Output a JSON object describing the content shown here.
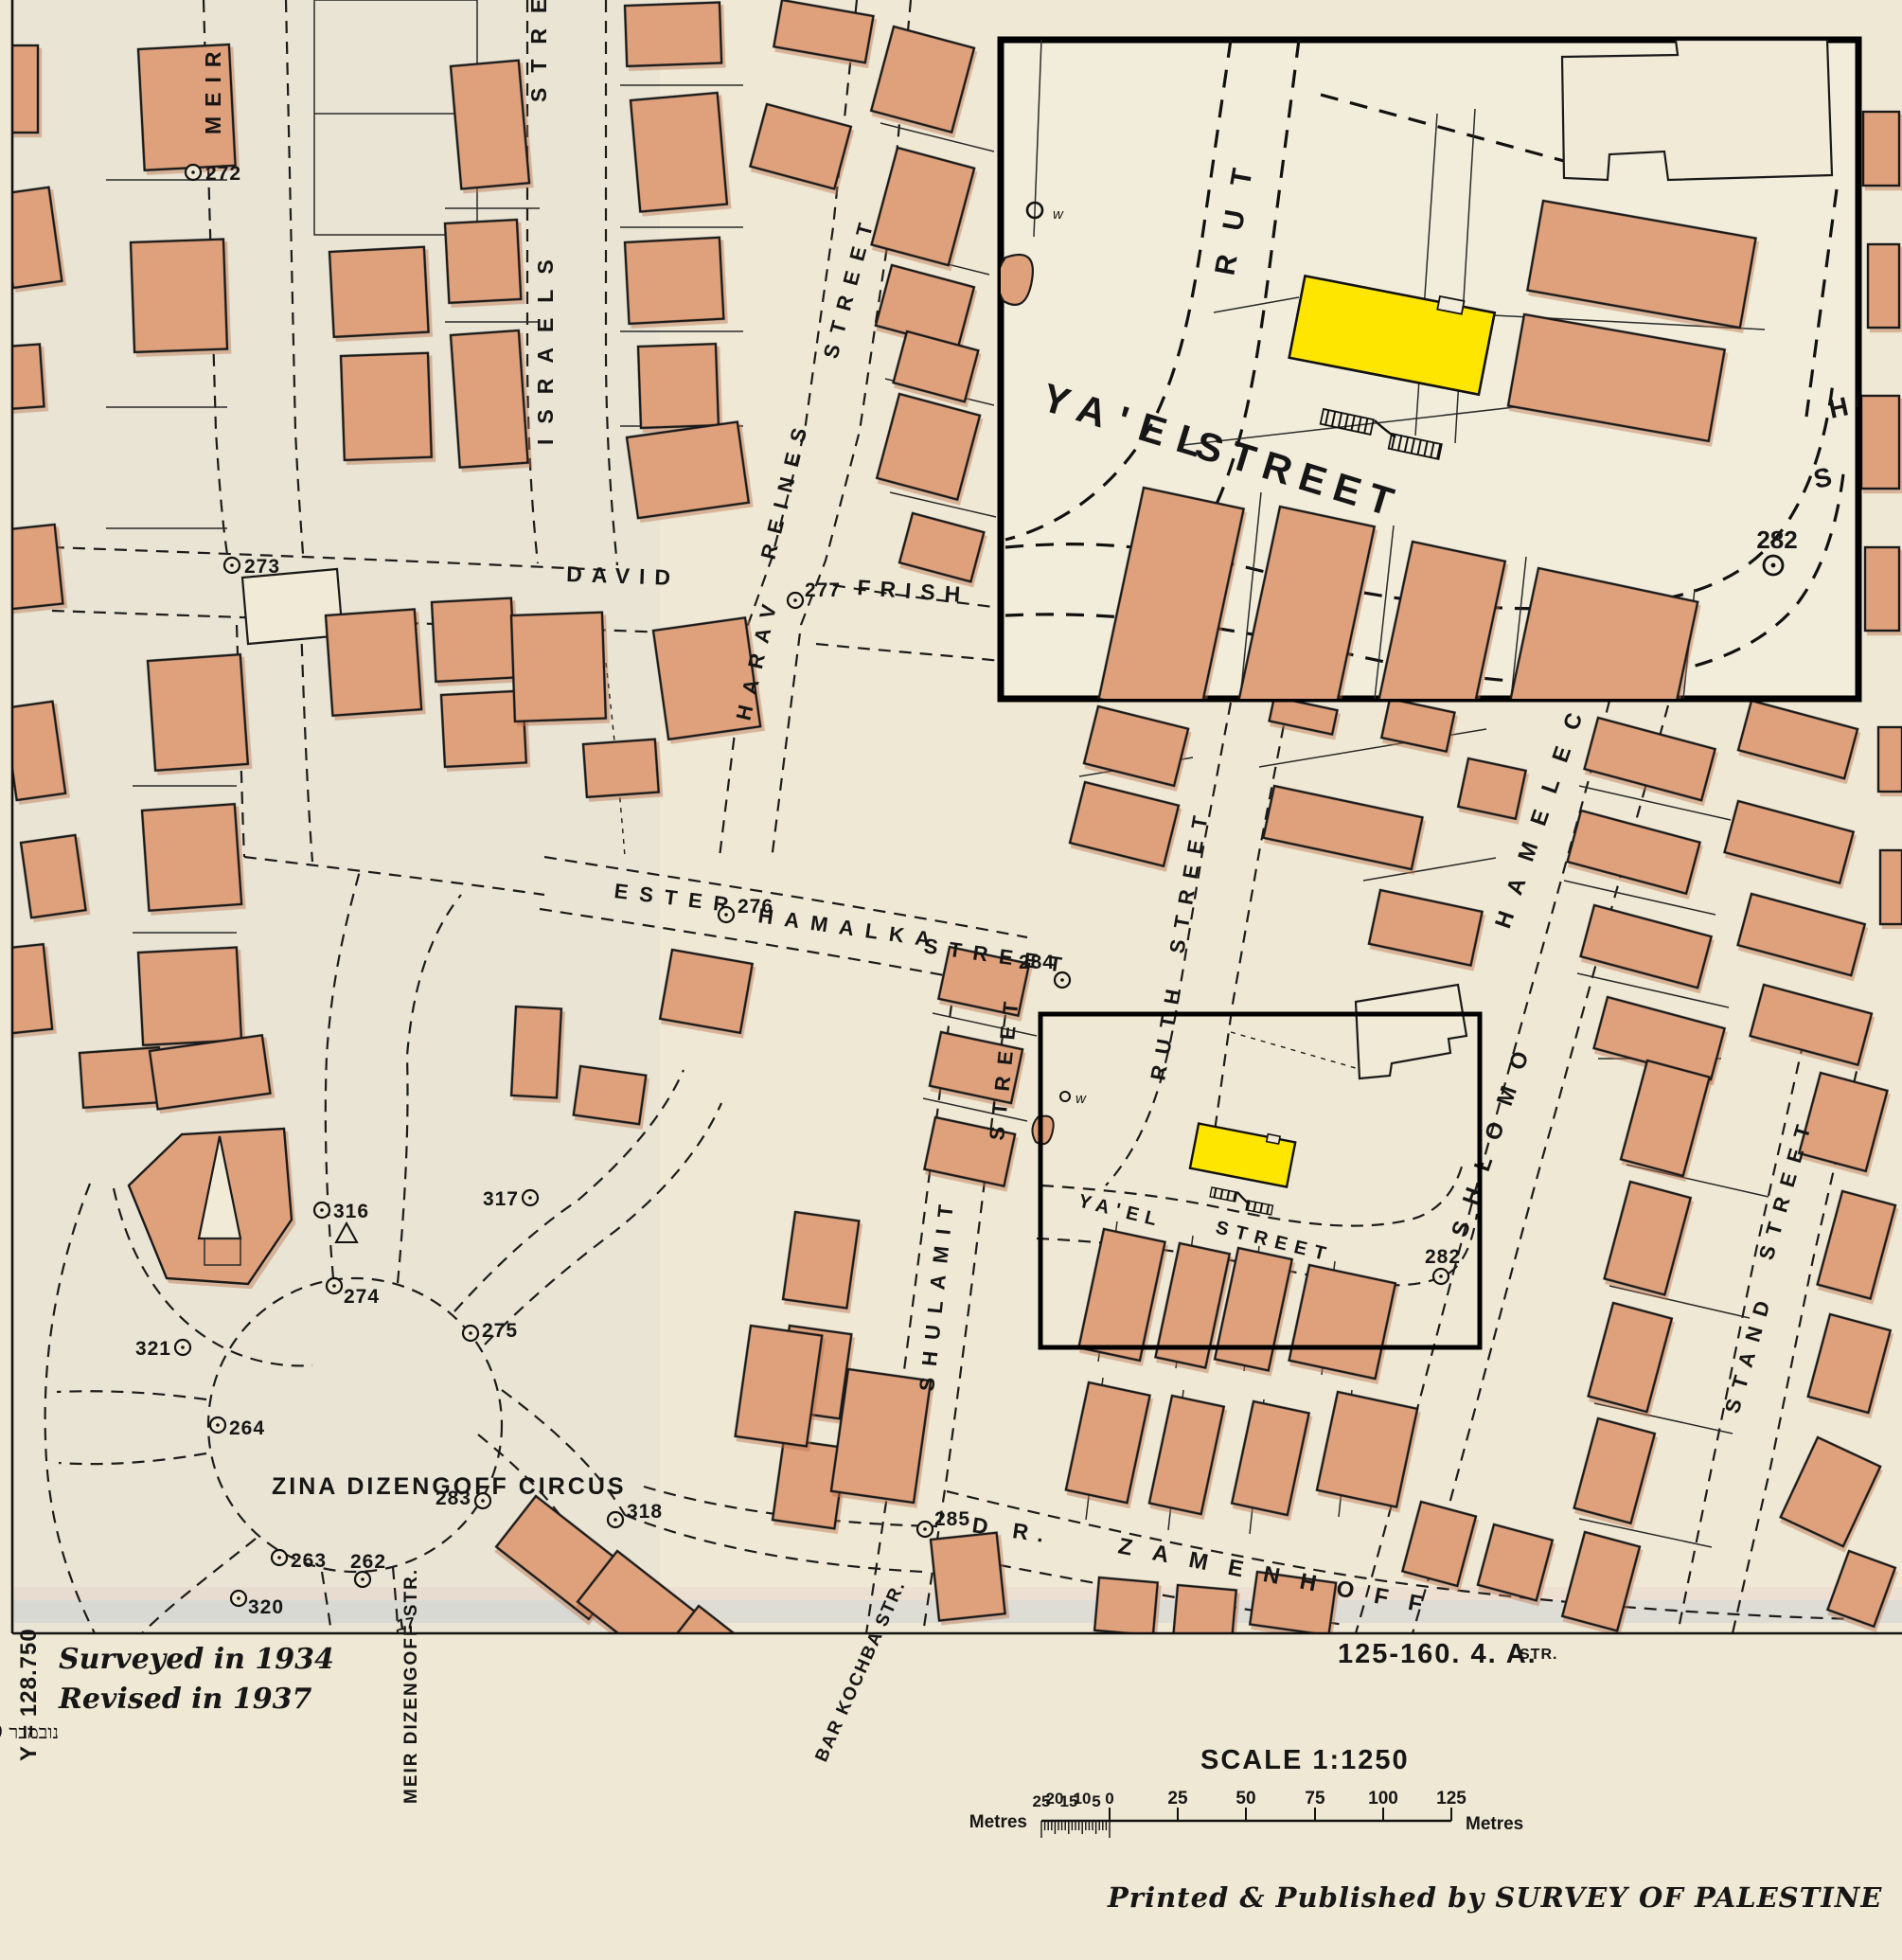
{
  "streets": {
    "meir": "MEIR",
    "israels": "ISRAELS",
    "israels_stre": "STRE",
    "harav": "HARAV",
    "reines": "REINES",
    "street_reines": "STREET",
    "david": "DAVID",
    "frish": "FRISH",
    "ester": "ESTER",
    "hamalka": "HAMALKA",
    "street_hamalka": "STREET",
    "shulamit": "SHULAMIT",
    "street_shulamit": "STREET",
    "ruth": "RUTH",
    "street_ruth": "STREET",
    "yael": "YA'EL",
    "street_yael": "STREET",
    "shlomo": "SHLOMO",
    "hamelec": "HAMELEC",
    "stand": "STAND",
    "street_stand": "STREET",
    "dr": "D R.",
    "zamenhoff": "ZAMENHOFF",
    "zina_circus": "ZINA DIZENGOFF CIRCUS",
    "meir_dizengoff": "MEIR DIZENGOFF STR.",
    "bar_kochba": "BAR KOCHBA STR.",
    "str_abbrev": "STR."
  },
  "inset": {
    "rut": "RUT",
    "yael": "YA'EL",
    "street": "STREET",
    "s": "S",
    "h": "H",
    "marker_282": "282"
  },
  "symbols": {
    "well": "w",
    "tiny_mark": "17"
  },
  "markers": [
    {
      "label": "272"
    },
    {
      "label": "273"
    },
    {
      "label": "277"
    },
    {
      "label": "276"
    },
    {
      "label": "284"
    },
    {
      "label": "316"
    },
    {
      "label": "317"
    },
    {
      "label": "274"
    },
    {
      "label": "275"
    },
    {
      "label": "321"
    },
    {
      "label": "264"
    },
    {
      "label": "283"
    },
    {
      "label": "318"
    },
    {
      "label": "263"
    },
    {
      "label": "262"
    },
    {
      "label": "320"
    },
    {
      "label": "285"
    },
    {
      "label": "282"
    }
  ],
  "margin": {
    "surveyed": "Surveyed in 1934",
    "revised": "Revised in 1937",
    "hebrew_date": "נובמבר 1949",
    "grid_y": "Y = 128.750",
    "sheet_ref": "125-160. 4. A.",
    "scale_text": "SCALE  1:1250",
    "imprint": "Printed & Published by SURVEY OF PALESTINE"
  },
  "scale_bar": {
    "left_label": "Metres",
    "right_label": "Metres",
    "sub_labels": [
      "25",
      "20",
      "15",
      "10",
      "5",
      "0"
    ],
    "main_labels": [
      "25",
      "50",
      "75",
      "100",
      "125"
    ]
  },
  "colors": {
    "paper": "#efe8d4",
    "building_fill": "#dfa17c",
    "line_ink": "#1a1a1a",
    "highlight_yellow": "#ffe600",
    "inset_paper": "#f2eddb"
  }
}
